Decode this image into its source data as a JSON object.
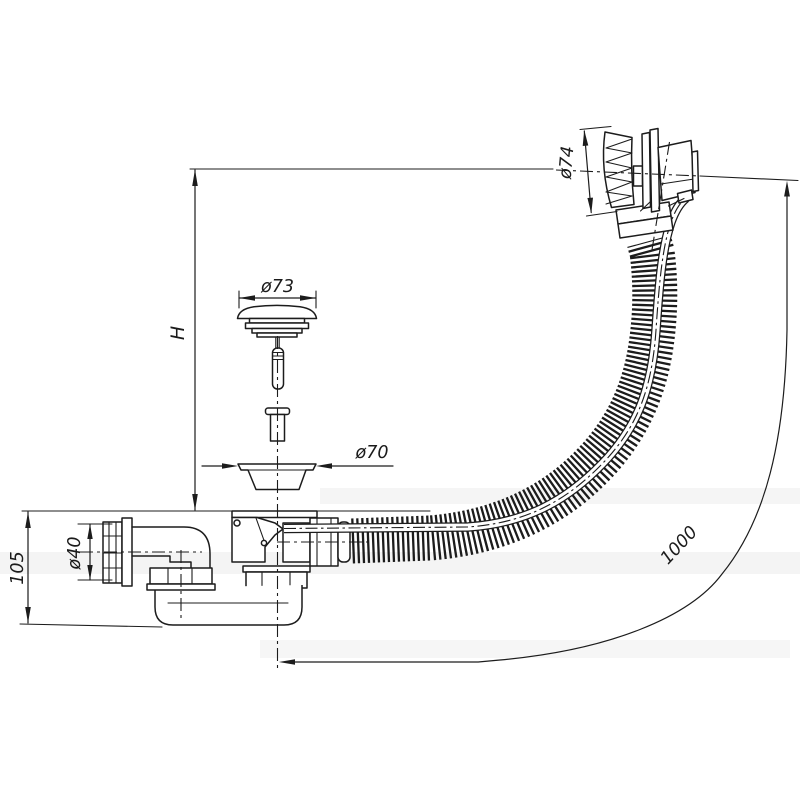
{
  "drawing": {
    "subject": "Bath waste and overflow assembly technical line drawing",
    "background_color": "#ffffff",
    "line_color": "#1c1c1c",
    "labels": {
      "height": "H",
      "trap_height": "105",
      "outlet_diameter": "ø40",
      "plug_diameter": "ø73",
      "waste_flange_diameter": "ø70",
      "overflow_head_diameter": "ø74",
      "hose_length": "1000"
    }
  }
}
